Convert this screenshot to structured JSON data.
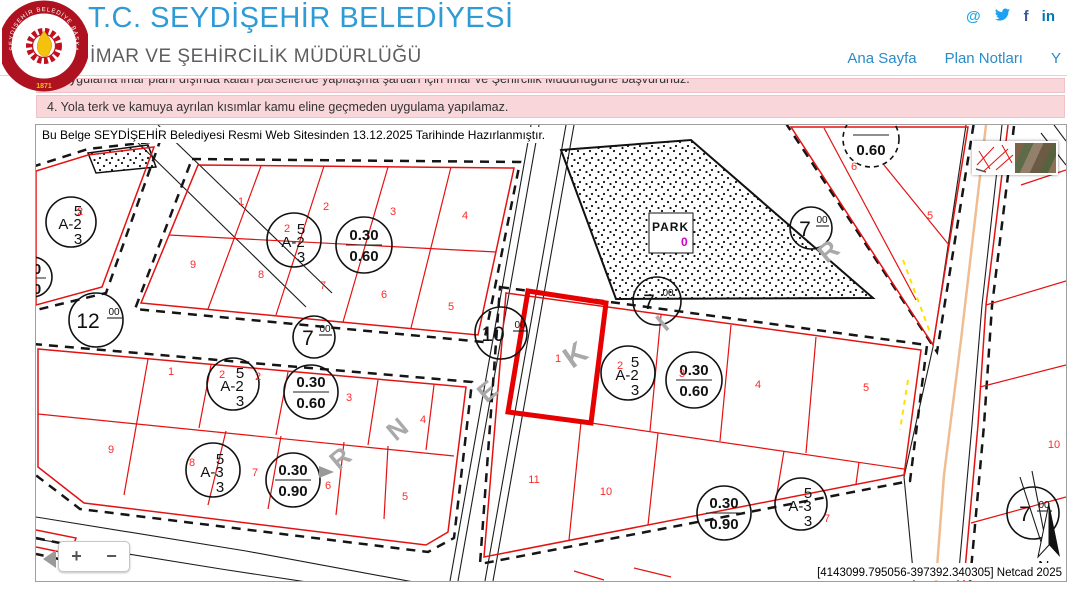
{
  "header": {
    "title": "T.C. SEYDİŞEHİR BELEDİYESİ",
    "subtitle": "İMAR VE ŞEHİRCİLİK MÜDÜRLÜĞÜ",
    "logo": {
      "ring_text": "SEYDİŞEHİR BELEDİYE BAŞKANLIĞI",
      "year": "1871"
    },
    "nav": [
      {
        "label": "Ana Sayfa"
      },
      {
        "label": "Plan Notları"
      },
      {
        "label": "Y"
      }
    ],
    "social": {
      "email": "@",
      "facebook": "f",
      "linkedin": "in"
    }
  },
  "notices": [
    {
      "text": "3. Uygulama imar planı dışında kalan parsellerde yapılaşma şartları için İmar ve Şehircilik Müdürlüğüne başvurunuz."
    },
    {
      "text": "4. Yola terk ve kamuya ayrılan kısımlar kamu eline geçmeden uygulama yapılamaz."
    }
  ],
  "map": {
    "doc_note": "Bu Belge SEYDİŞEHİR Belediyesi Resmi Web Sitesinden 13.12.2025 Tarihinde Hazırlanmıştır.",
    "coords_note": "[4143099.795056-397392.340305] Netcad 2025",
    "park": {
      "label": "PARK",
      "marker": "0"
    },
    "north": "N",
    "zoom": {
      "in": "+",
      "out": "−"
    },
    "parcels": [
      "1",
      "2",
      "3",
      "4",
      "9",
      "8",
      "7",
      "6",
      "5",
      "2",
      "2",
      "1",
      "2",
      "2",
      "3",
      "4",
      "5",
      "9",
      "8",
      "7",
      "6",
      "1",
      "2",
      "3",
      "4",
      "5",
      "11",
      "10",
      "7",
      "6",
      "5",
      "10"
    ],
    "a_circles": [
      {
        "top": "5",
        "mid": "A-2",
        "bot": "3"
      },
      {
        "top": "5",
        "mid": "A-2",
        "bot": "3"
      },
      {
        "top": "5",
        "mid": "A-2",
        "bot": "3"
      },
      {
        "top": "5",
        "mid": "A-3",
        "bot": "3"
      },
      {
        "top": "5",
        "mid": "A-2",
        "bot": "3"
      },
      {
        "top": "5",
        "mid": "A-3",
        "bot": "3"
      }
    ],
    "f_circles": [
      {
        "num": "0.30",
        "den": "0.60"
      },
      {
        "num": "0.30",
        "den": "0.60"
      },
      {
        "num": "0.30",
        "den": "0.90"
      },
      {
        "num": "0.30",
        "den": "0.60"
      },
      {
        "num": "0.30",
        "den": "0.90"
      },
      {
        "num": "0.60",
        "den": ""
      },
      {
        "num": "0",
        "den": "0"
      }
    ],
    "road_circles": [
      {
        "main": "12",
        "sup": "00"
      },
      {
        "main": "7",
        "sup": "00"
      },
      {
        "main": "7",
        "sup": "00"
      },
      {
        "main": "7",
        "sup": "00"
      },
      {
        "main": "10",
        "sup": "00"
      },
      {
        "main": "7",
        "sup": "00"
      }
    ],
    "street_letters": [
      "R",
      "N",
      "E",
      "K",
      "I",
      "R"
    ],
    "colors": {
      "parcel_red": "#e31212",
      "selected_red": "#e60000",
      "number_red": "#ff2a2a",
      "street_gray": "#a9a9a9",
      "road_orange": "#f0bd93",
      "park_marker_magenta": "#cc00cc",
      "accent_blue": "#2e9bd6",
      "nav_blue": "#2a8bc9",
      "notice_pink": "#f8d6d9"
    }
  }
}
